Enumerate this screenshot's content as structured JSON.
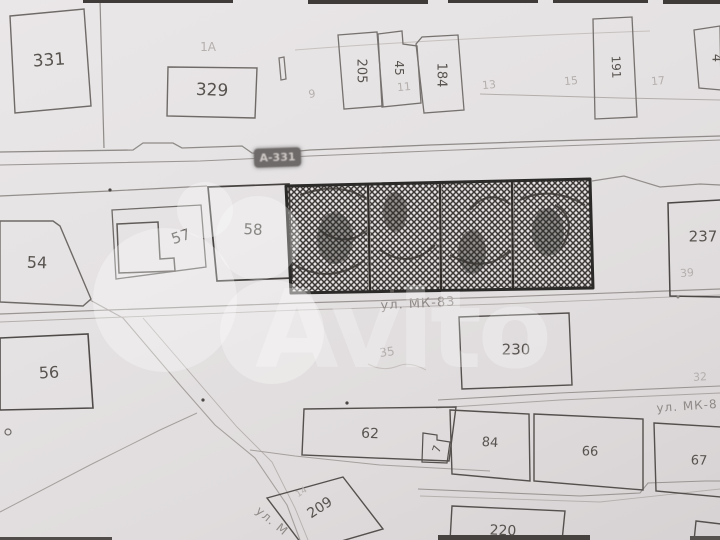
{
  "watermark": {
    "brand": "Avito"
  },
  "road_labels": {
    "a331": "А-331",
    "mk83": "ул. МК-83",
    "mk8": "ул. МК-8",
    "m_diag": "ул. М"
  },
  "parcel_labels": {
    "p331": "331",
    "p329": "329",
    "p205": "205",
    "p45": "45",
    "p184": "184",
    "p191": "191",
    "p4": "4",
    "p57": "57",
    "p58": "58",
    "p54": "54",
    "p237": "237",
    "p230": "230",
    "p56": "56",
    "p62": "62",
    "p7": "7",
    "p84": "84",
    "p66": "66",
    "p67": "67",
    "p220": "220",
    "p209": "209"
  },
  "faint_labels": {
    "l1a": "1А",
    "l9": "9",
    "l11": "11",
    "l13": "13",
    "l15": "15",
    "l17": "17",
    "l39": "39",
    "l35": "35",
    "l32": "32",
    "l14": "14"
  },
  "colors": {
    "paper": "#e5e2e3",
    "hatch_ink": "#3a3734",
    "pencil": "#57534f",
    "faint_print": "#b4afad",
    "road_badge": "#6e6a6a",
    "street_label": "#8f8a87"
  }
}
